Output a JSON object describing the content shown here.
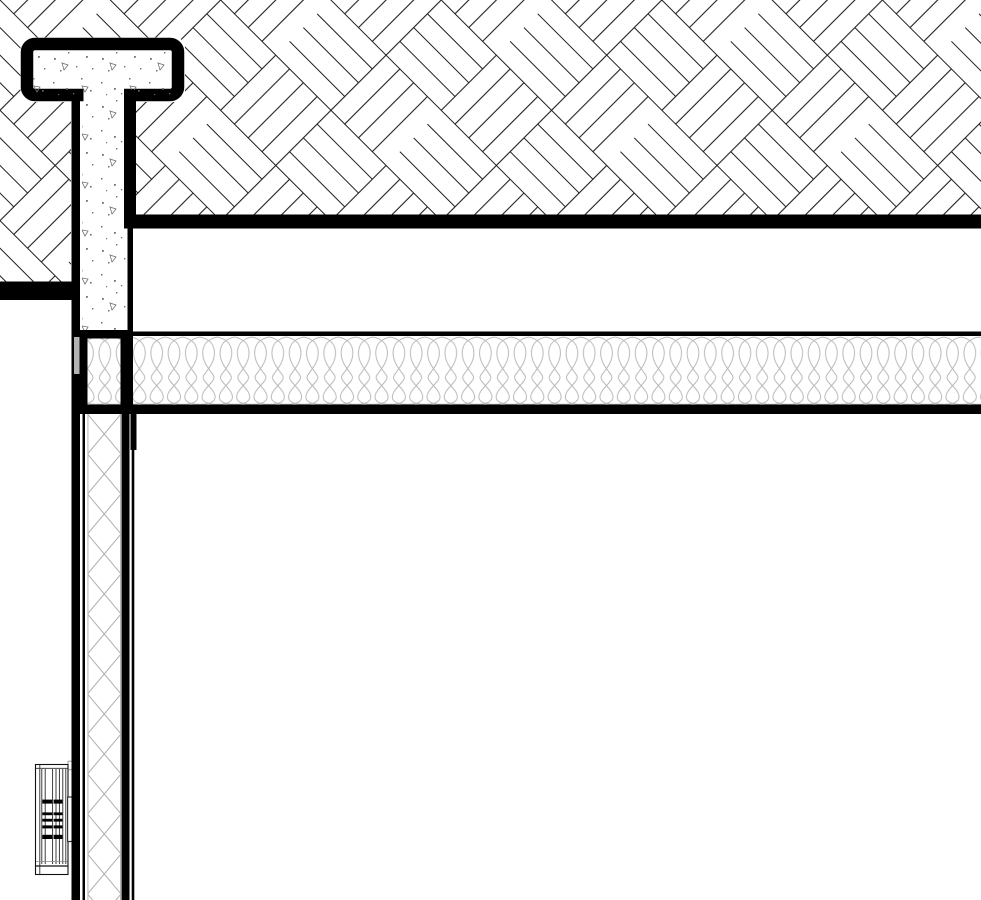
{
  "document": {
    "kind": "cad-detail-section",
    "title": "Wall and floor junction construction detail",
    "visible_text": []
  },
  "canvas": {
    "width": 981,
    "height": 900
  },
  "colors": {
    "paper": "#ffffff",
    "ink": "#000000",
    "hatch_line": "#1f1f1f",
    "batt_line": "#b9b9b9",
    "lattice_line": "#adadad",
    "membrane_gray": "#b3b3b3",
    "radiator_line": "#2a2a2a"
  },
  "patterns": {
    "masonry": "herringbone-45deg",
    "grout_fill": "concrete-stipple",
    "ceiling_insulation": "batt-loops",
    "wall_insulation": "diagonal-lattice"
  },
  "components": [
    "masonry-hatch-region",
    "steel-tee-profile",
    "concrete-grout-fill",
    "floor-slab-edge-band",
    "masonry-ledge-band",
    "batt-insulation-band",
    "wall-insulation-strip",
    "wall-face-lines",
    "membrane-strip",
    "radiator-unit",
    "mounting-bracket"
  ]
}
